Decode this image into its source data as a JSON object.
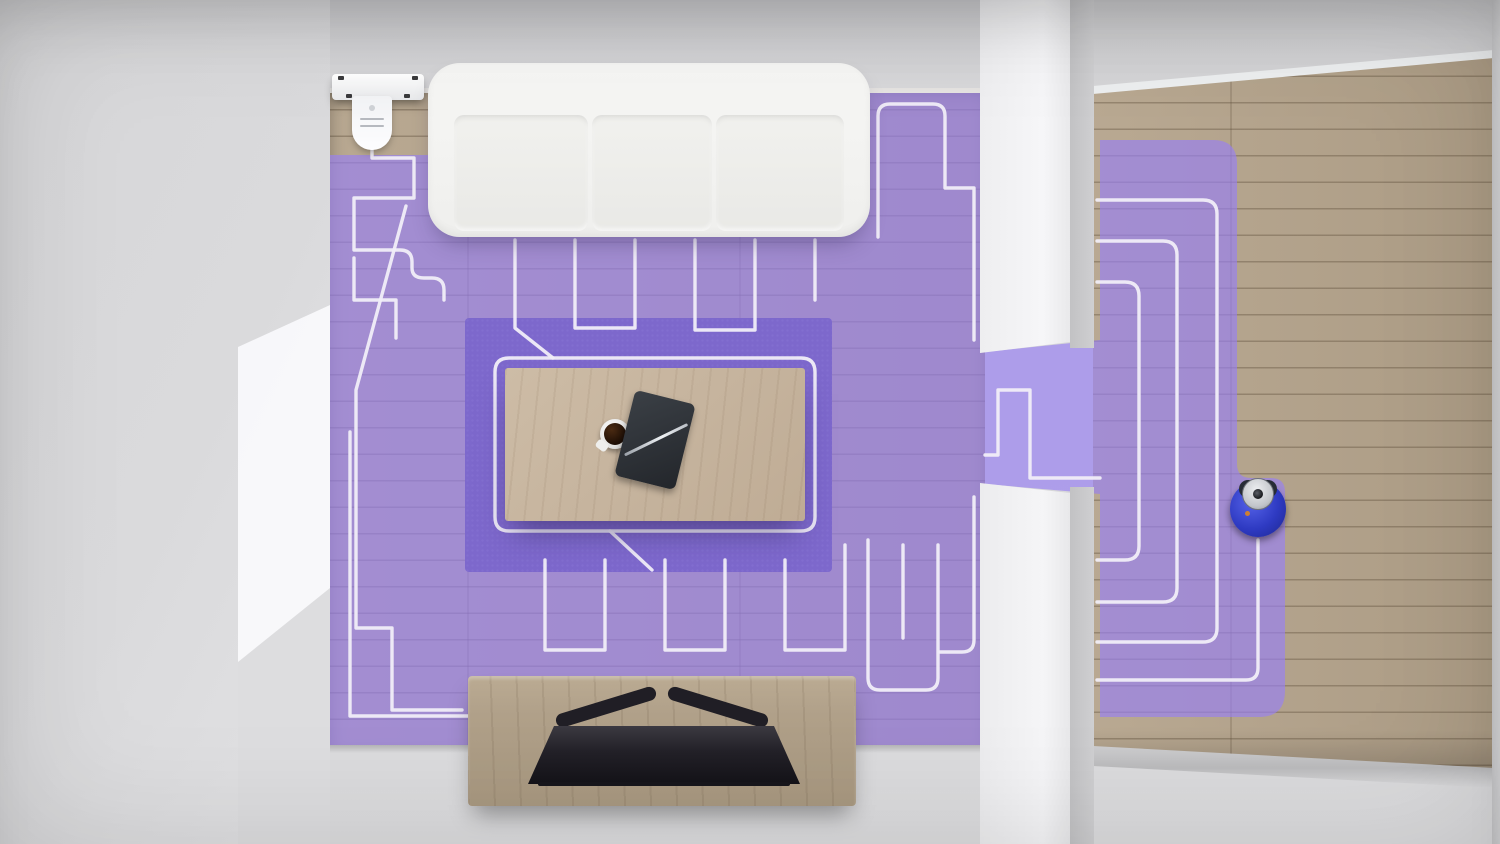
{
  "scene": {
    "description": "Top-down 3D render of a living room and hallway showing a robot vacuum's cleaning coverage map: purple shaded cleaned area with white boustrophedon path lines, charging dock top-left, robot currently cleaning the right hallway",
    "objects": [
      "charging-dock",
      "sofa",
      "area-rug",
      "coffee-table",
      "coffee-cup",
      "notebook",
      "pen",
      "tv-console",
      "tv",
      "doorway",
      "wood-floor",
      "cleaning-coverage-overlay",
      "cleaning-path-lines",
      "robot-vacuum"
    ],
    "rooms": [
      "living-room",
      "hallway"
    ]
  },
  "colors": {
    "wood": "#b5a48c",
    "rug": "#4a3c82",
    "purple-overlay": "rgba(152,127,243,0.66)",
    "path-line": "#f1eef8",
    "sofa-fabric": "#f2f2f0",
    "table-wood": "#c6b49e",
    "console-wood": "#b0a089",
    "tv-black": "#232128",
    "robot-blue": "#2e3ac2",
    "robot-cap-silver": "#c9ccd1",
    "dock-white": "#f6f7f9",
    "wall-white": "#f4f4f6",
    "wall-gray": "#d6d6d8",
    "coffee-brown": "#1d0e05",
    "sensor-orange": "#cd7f32"
  }
}
